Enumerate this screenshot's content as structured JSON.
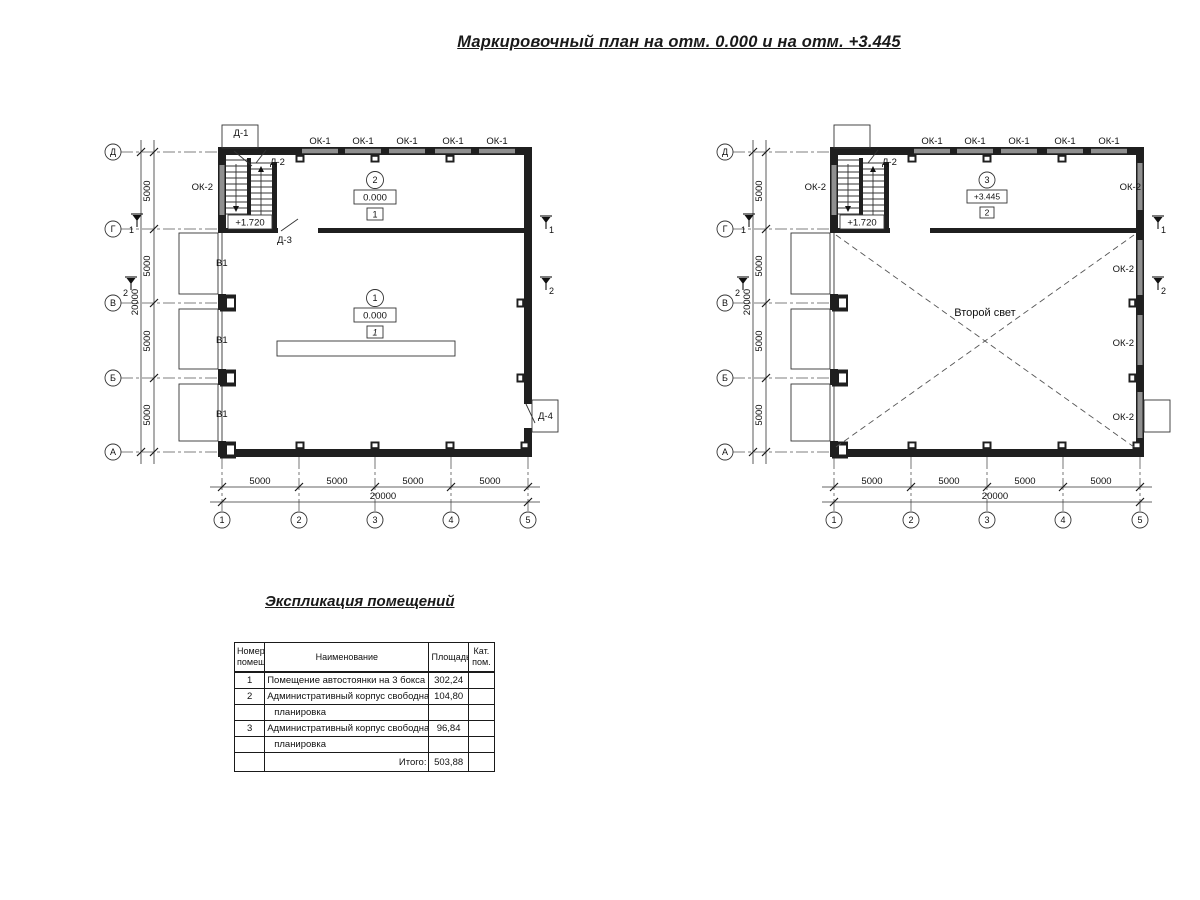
{
  "title": "Маркировочный план на отм. 0.000 и на отм. +3.445",
  "labels": {
    "ok1": "ОК-1",
    "ok2": "ОК-2",
    "v1": "В1",
    "d1": "Д-1",
    "d2": "Д-2",
    "d3": "Д-3",
    "d4": "Д-4",
    "stair_level": "+1.720",
    "second_light": "Второй свет"
  },
  "axes": {
    "rows": [
      "Д",
      "Г",
      "В",
      "Б",
      "А"
    ],
    "cols": [
      "1",
      "2",
      "3",
      "4",
      "5"
    ],
    "bay": "5000",
    "total": "20000"
  },
  "rooms": {
    "r1": {
      "num": "1",
      "level": "0.000",
      "cat": "1"
    },
    "r2": {
      "num": "2",
      "level": "0.000",
      "cat": "1"
    },
    "r3": {
      "num": "3",
      "level": "+3.445",
      "cat": "2"
    }
  },
  "sections": {
    "s1": "1",
    "s2": "2"
  },
  "explication": {
    "title": "Экспликация помещений",
    "headers": {
      "num": "Номер помещ.",
      "name": "Наименование",
      "area": "Площадь",
      "cat": "Кат. пом."
    },
    "rows": [
      {
        "num": "1",
        "name": "Помещение автостоянки на 3 бокса",
        "area": "302,24",
        "cat": ""
      },
      {
        "num": "2",
        "name": "Административный корпус свободная",
        "area": "104,80",
        "cat": ""
      },
      {
        "num": "",
        "name": "планировка",
        "area": "",
        "cat": ""
      },
      {
        "num": "3",
        "name": "Административный корпус свободная",
        "area": "96,84",
        "cat": ""
      },
      {
        "num": "",
        "name": "планировка",
        "area": "",
        "cat": ""
      },
      {
        "num": "",
        "name": "Итого:",
        "area": "503,88",
        "cat": ""
      }
    ]
  }
}
